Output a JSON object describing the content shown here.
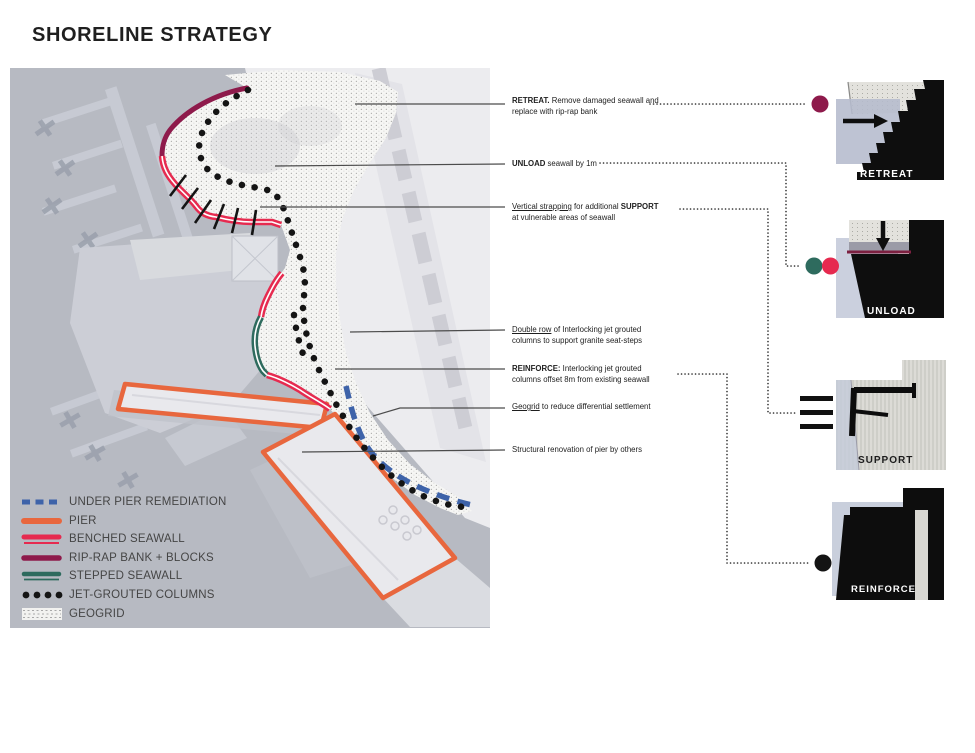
{
  "title": "SHORELINE STRATEGY",
  "legend": {
    "items": [
      {
        "label": "UNDER PIER REMEDIATION"
      },
      {
        "label": "PIER"
      },
      {
        "label": "BENCHED SEAWALL"
      },
      {
        "label": "RIP-RAP BANK + BLOCKS"
      },
      {
        "label": "STEPPED SEAWALL"
      },
      {
        "label": "JET-GROUTED COLUMNS"
      },
      {
        "label": "GEOGRID"
      }
    ]
  },
  "annotations": [
    {
      "em": "RETREAT.",
      "mid": " Remove damaged seawall and",
      "bold2": "",
      "line2": "replace with rip-rap bank"
    },
    {
      "em": "UNLOAD",
      "mid": " seawall by 1m",
      "bold2": "",
      "line2": ""
    },
    {
      "em": "Vertical strapping",
      "mid": " for additional ",
      "bold2": "SUPPORT",
      "line2": "at vulnerable areas of seawall"
    },
    {
      "em": "Double row",
      "mid": " of Interlocking jet grouted",
      "bold2": "",
      "line2": "columns to support granite seat-steps"
    },
    {
      "em": "REINFORCE:",
      "mid": " Interlocking jet grouted",
      "bold2": "",
      "line2": "columns offset 8m from existing seawall"
    },
    {
      "em": "Geogrid",
      "mid": " to reduce differential settlement",
      "bold2": "",
      "line2": ""
    },
    {
      "em": "",
      "mid": "Structural renovation of pier by others",
      "bold2": "",
      "line2": ""
    }
  ],
  "details": [
    {
      "label": "RETREAT"
    },
    {
      "label": "UNLOAD"
    },
    {
      "label": "SUPPORT"
    },
    {
      "label": "REINFORCE"
    }
  ],
  "colors": {
    "water": "#b7bac2",
    "under_pier_blue": "#3e63a9",
    "pier_orange": "#e8673e",
    "benched_red": "#e62a4f",
    "riprap_maroon": "#8e1a4b",
    "stepped_teal": "#2e6b5e",
    "jet_column_black": "#141414",
    "geogrid_gray": "#9a9a9a"
  }
}
